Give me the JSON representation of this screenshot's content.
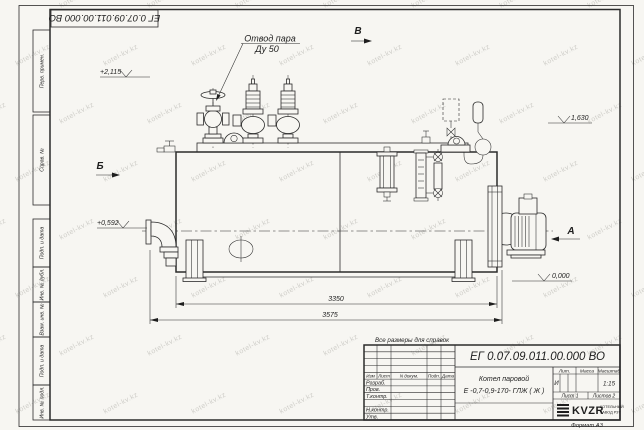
{
  "sheet": {
    "format_note": "Формат А3",
    "reference_note": "Все размеры для справок"
  },
  "margin_stamps": {
    "top_box": "ЕГ 0.07.09.011.00.000  ВО",
    "left_labels": [
      "Перв. примен.",
      "Справ. №",
      "Подп. и дата",
      "Инв. № дубл.",
      "Взам. инв. №",
      "Подп. и дата",
      "Инв. № подл."
    ]
  },
  "annotations": {
    "callout_line1": "Отвод пара",
    "callout_line2": "Ду 50",
    "section_a": "А",
    "section_b": "Б",
    "section_v": "В",
    "elev_top": "+2,115",
    "elev_mid": "+0,592",
    "elev_zero": "0,000",
    "elev_right": "1,630",
    "dim_inner": "3350",
    "dim_outer": "3575"
  },
  "title_block": {
    "doc_number": "ЕГ 0.07.09.011.00.000  ВО",
    "product_line1": "Котел паровой",
    "product_line2": "Е -0,7-0,9-170- ГЛЖ ( Ж )",
    "cols": [
      "Изм",
      "Лист",
      "N докум.",
      "Подп.",
      "Дата"
    ],
    "rows": [
      "Разраб.",
      "Пров.",
      "Т.контр.",
      "Н.контр.",
      "Утв."
    ],
    "lit_label": "Лит.",
    "mass_label": "Масса",
    "scale_label": "Масштаб",
    "lit_value": "И",
    "scale_value": "1:15",
    "sheet_label": "Лист 1",
    "sheets_label": "Листов 2",
    "company_logo": "KVZR",
    "company_line1": "КОТЕЛЬНЫЙ",
    "company_line2": "ЗАВОД РЗТ"
  },
  "watermark": {
    "text": "kotel-kv.kz",
    "color": "#cfcec9"
  }
}
